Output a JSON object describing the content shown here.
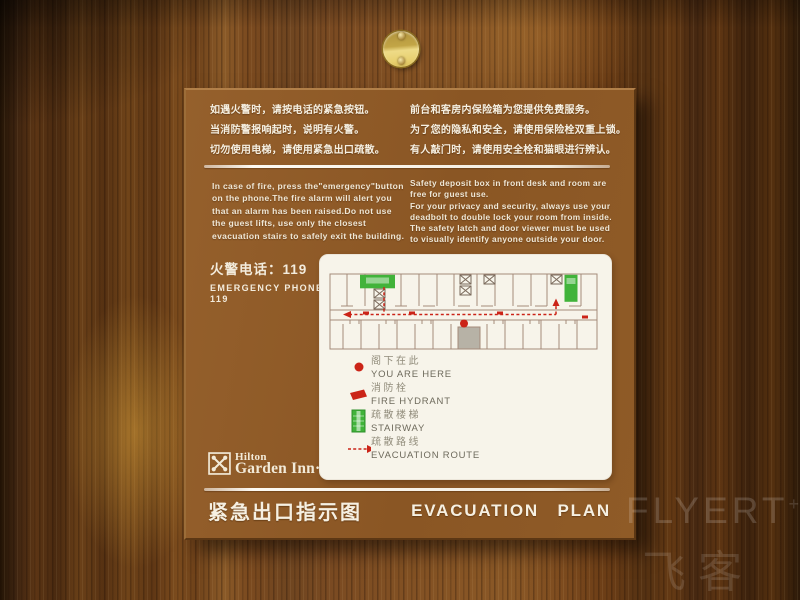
{
  "colors": {
    "sign_brown": "#8a5624",
    "sign_brown_light": "#95602c",
    "panel_white": "#f7f4ea",
    "stair_green": "#41b33a",
    "route_red": "#cb2418",
    "map_line": "#a48b7a",
    "brass_gold": "#e8d070"
  },
  "sign": {
    "notice_cn_left": [
      "如遇火警时，请按电话的紧急按钮。",
      "当消防警报响起时，说明有火警。",
      "切勿使用电梯，请使用紧急出口疏散。"
    ],
    "notice_cn_right": [
      "前台和客房内保险箱为您提供免费服务。",
      "为了您的隐私和安全，请使用保险栓双重上锁。",
      "有人敲门时，请使用安全栓和猫眼进行辨认。"
    ],
    "notice_en_left": [
      "In case of fire, press the\"emergency\"button",
      "on the phone.The fire alarm will alert you",
      "that an alarm has been raised.Do not use",
      "the guest lifts, use only the closest",
      "evacuation stairs to safely exit the building."
    ],
    "notice_en_right": [
      "Safety deposit box in front desk and room are",
      "free for guest use.",
      "For your privacy and security, always use your",
      "deadbolt to double lock your room from inside.",
      "The safety latch and door viewer must be used",
      "to visually identify anyone outside your door."
    ],
    "emergency_phone": {
      "cn": "火警电话：119",
      "en": "EMERGENCY PHONE",
      "number": "119"
    },
    "legend": {
      "items": [
        {
          "icon": "you-are-here-dot-icon",
          "cn": "阁下在此",
          "en": "YOU ARE HERE"
        },
        {
          "icon": "fire-hydrant-icon",
          "cn": "消防栓",
          "en": "FIRE HYDRANT"
        },
        {
          "icon": "stairway-icon",
          "cn": "疏散楼梯",
          "en": "STAIRWAY"
        },
        {
          "icon": "evacuation-route-icon",
          "cn": "疏散路线",
          "en": "EVACUATION ROUTE"
        }
      ]
    },
    "logo": {
      "line1": "Hilton",
      "line2": "Garden Inn·"
    },
    "footer": {
      "title_cn": "紧急出口指示图",
      "title_en": "EVACUATION PLAN"
    }
  },
  "watermark": {
    "brand": "FLYERT",
    "plus": "+",
    "cn": "飞客"
  }
}
